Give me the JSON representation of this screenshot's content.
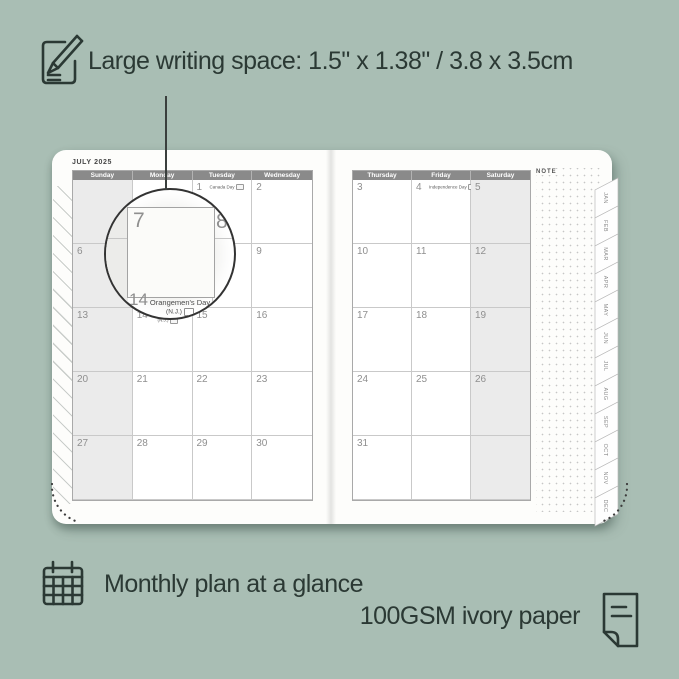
{
  "colors": {
    "background": "#a9beb4",
    "ink": "#2b3934",
    "header_bar": "#8a8a8a",
    "page": "#fdfdfb",
    "shaded_column": "#ebebeb",
    "date_text": "#8f8f8f"
  },
  "captions": {
    "writing_space": "Large writing space: 1.5\" x 1.38\" / 3.8 x 3.5cm",
    "monthly_plan": "Monthly plan at a glance",
    "paper": "100GSM ivory paper"
  },
  "planner": {
    "month_title": "JULY 2025",
    "note_label": "NOTE",
    "left_page": {
      "day_headers": [
        "Sunday",
        "Monday",
        "Tuesday",
        "Wednesday"
      ],
      "rows": [
        [
          {
            "date": ""
          },
          {
            "date": ""
          },
          {
            "date": "1",
            "holiday": "Canada Day"
          },
          {
            "date": "2"
          }
        ],
        [
          {
            "date": "6"
          },
          {
            "date": "7"
          },
          {
            "date": "8"
          },
          {
            "date": "9"
          }
        ],
        [
          {
            "date": "13"
          },
          {
            "date": "14",
            "holiday": "Orangemen's Day (N.J.)"
          },
          {
            "date": "15"
          },
          {
            "date": "16"
          }
        ],
        [
          {
            "date": "20"
          },
          {
            "date": "21"
          },
          {
            "date": "22"
          },
          {
            "date": "23"
          }
        ],
        [
          {
            "date": "27"
          },
          {
            "date": "28"
          },
          {
            "date": "29"
          },
          {
            "date": "30"
          }
        ]
      ]
    },
    "right_page": {
      "day_headers": [
        "Thursday",
        "Friday",
        "Saturday"
      ],
      "rows": [
        [
          {
            "date": "3"
          },
          {
            "date": "4",
            "holiday": "Independence Day"
          },
          {
            "date": "5"
          }
        ],
        [
          {
            "date": "10"
          },
          {
            "date": "11"
          },
          {
            "date": "12"
          }
        ],
        [
          {
            "date": "17"
          },
          {
            "date": "18"
          },
          {
            "date": "19"
          }
        ],
        [
          {
            "date": "24"
          },
          {
            "date": "25"
          },
          {
            "date": "26"
          }
        ],
        [
          {
            "date": "31"
          },
          {
            "date": ""
          },
          {
            "date": ""
          }
        ]
      ]
    },
    "month_tabs": [
      "JAN",
      "FEB",
      "MAR",
      "APR",
      "MAY",
      "JUN",
      "JUL",
      "AUG",
      "SEP",
      "OCT",
      "NOV",
      "DEC"
    ],
    "magnifier": {
      "day_a": "7",
      "day_b": "8",
      "day_c": "14",
      "holiday_line1": "Orangemen's Day",
      "holiday_line2": "(N.J.)"
    }
  }
}
